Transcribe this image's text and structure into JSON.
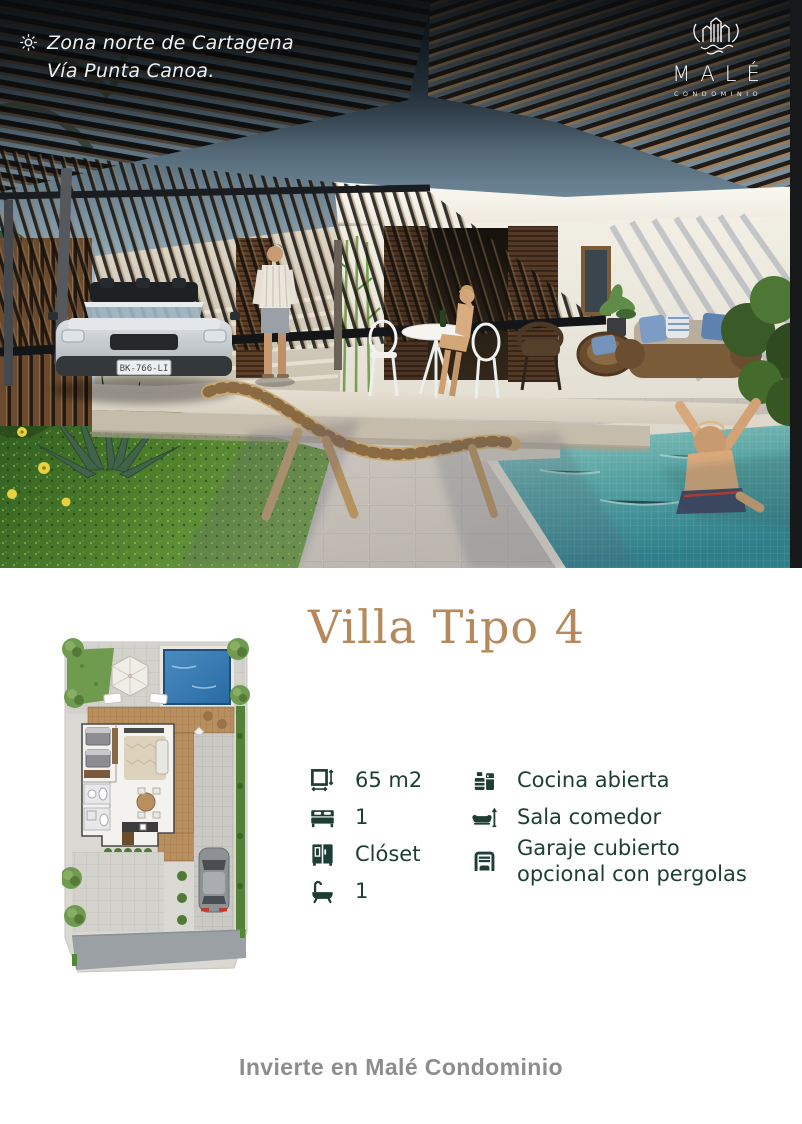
{
  "header": {
    "location_line1": "Zona norte de Cartagena",
    "location_line2": "Vía Punta Canoa.",
    "brand": "MALÉ",
    "brand_subtitle": "CONDOMINIO"
  },
  "photo": {
    "description": "Render of modern villa with slatted pergola, carport with convertible car, couple on terrace, daybed, wooden lounge chair, garden and child sitting at pool edge",
    "license_plate": "BK-766-LI"
  },
  "unit": {
    "title": "Villa Tipo 4",
    "features_left": [
      {
        "icon": "area-icon",
        "label": "65 m2"
      },
      {
        "icon": "bed-icon",
        "label": "1"
      },
      {
        "icon": "closet-icon",
        "label": "Clóset"
      },
      {
        "icon": "bath-icon",
        "label": "1"
      }
    ],
    "features_right": [
      {
        "icon": "kitchen-icon",
        "label": "Cocina abierta"
      },
      {
        "icon": "sofa-icon",
        "label": "Sala comedor"
      },
      {
        "icon": "garage-icon",
        "label": "Garaje cubierto opcional con pergolas"
      }
    ]
  },
  "footer": {
    "cta": "Invierte en Malé Condominio"
  },
  "colors": {
    "title_tan": "#b5895c",
    "feature_green": "#1e3d35",
    "footer_gray": "#8d8d8d",
    "pool_plan_blue": "#3f7fb5",
    "pool_water_teal": "#4f9da0",
    "sky_dark": "#232e38",
    "wood_tan": "#c9a873"
  }
}
